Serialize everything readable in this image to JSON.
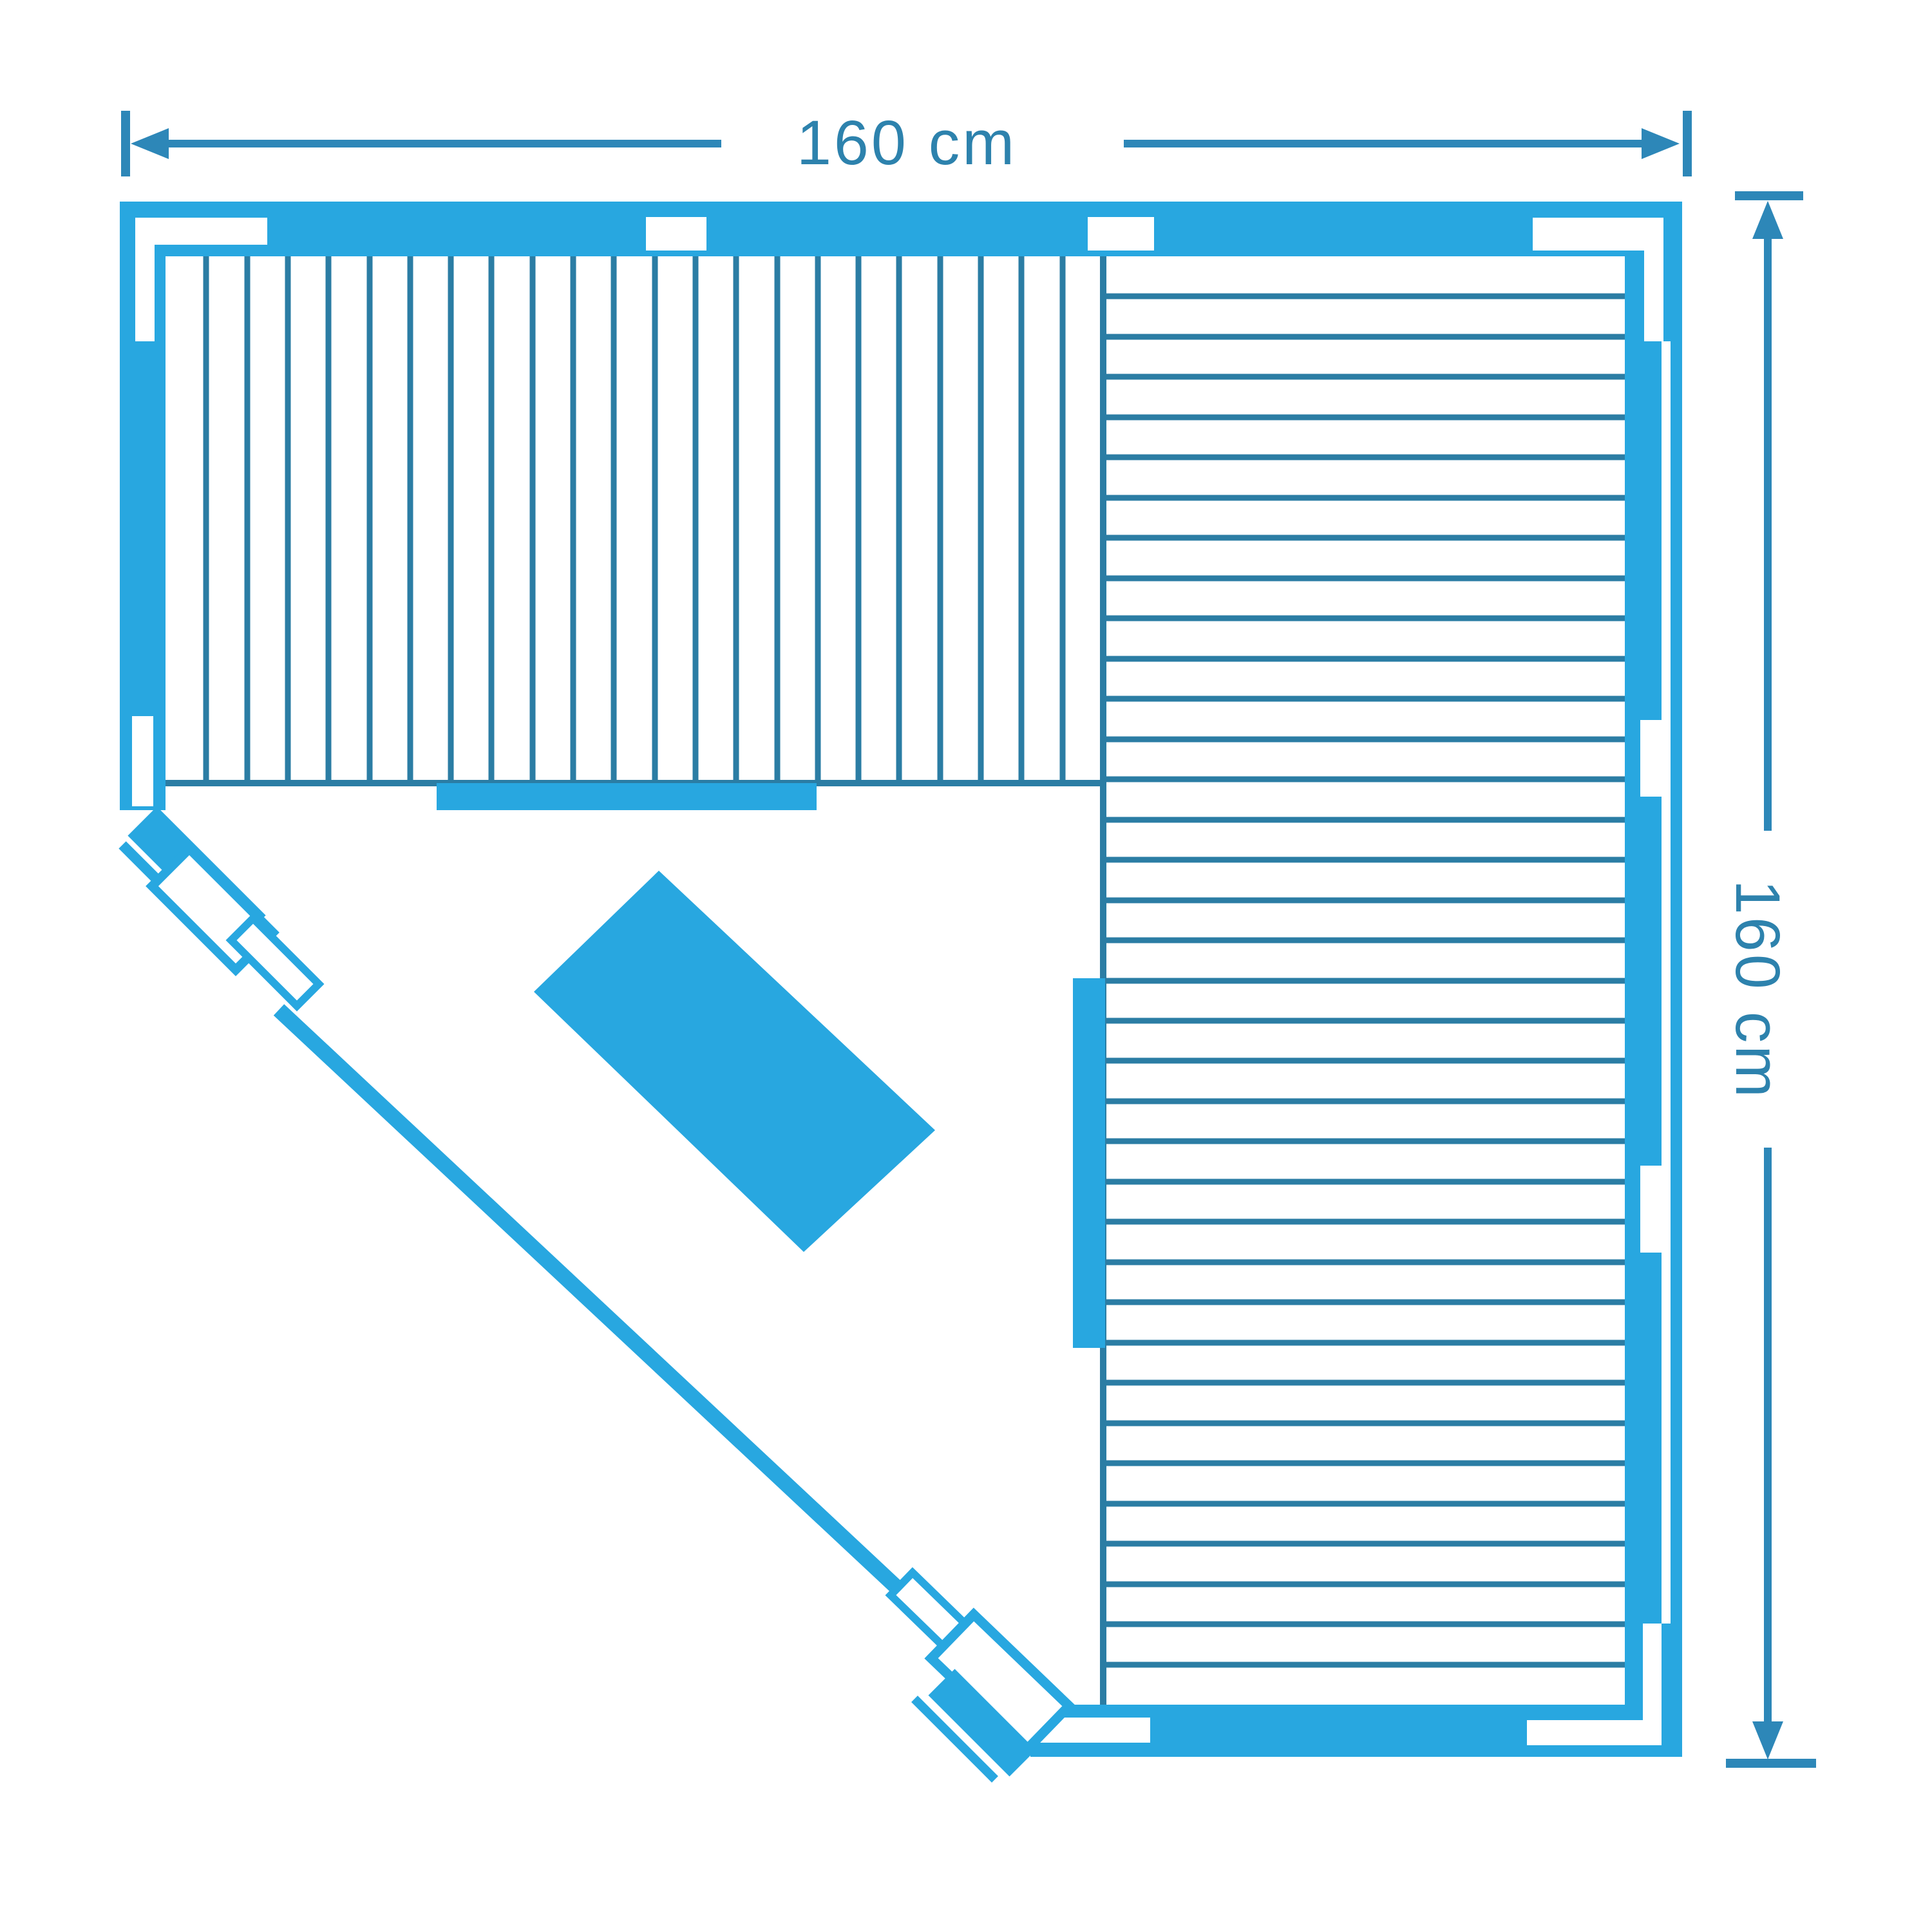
{
  "diagram": {
    "kind": "floor-plan",
    "subject": "corner sauna top view schematic",
    "colors": {
      "primary": "#28a7e0",
      "slat_line": "#2b7da4",
      "dimension": "#2d87b8",
      "label_text": "#2d82ad",
      "background": "#ffffff"
    },
    "dimension_top": {
      "label": "160 cm"
    },
    "dimension_right": {
      "label": "160 cm"
    },
    "benches": {
      "top_slat_count": 23,
      "right_slat_count": 36
    }
  }
}
